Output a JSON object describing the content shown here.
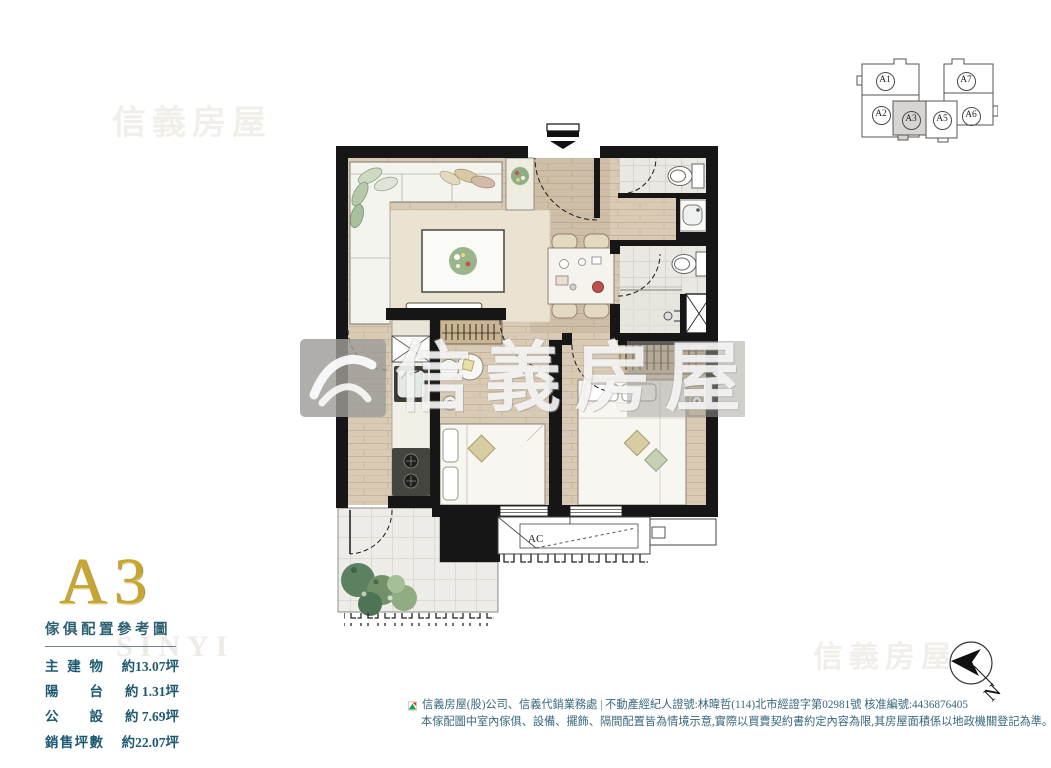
{
  "meta": {
    "brand_cn": "信義房屋",
    "brand_en": "SINYI"
  },
  "colors": {
    "accent_teal": "#2c6172",
    "table_text": "#1d5a72",
    "gold": "#c7a531",
    "wall_black": "#161616",
    "wood_floor": "#d8cab4",
    "logo_green": "#1e9e4a",
    "logo_red": "#d03a2b"
  },
  "keyplan": {
    "units": [
      {
        "label": "A1",
        "highlighted": false
      },
      {
        "label": "A7",
        "highlighted": false
      },
      {
        "label": "A2",
        "highlighted": false
      },
      {
        "label": "A3",
        "highlighted": true
      },
      {
        "label": "A5",
        "highlighted": false
      },
      {
        "label": "A6",
        "highlighted": false
      }
    ]
  },
  "floorplan": {
    "ac_label": "AC"
  },
  "compass": {
    "north_label": "N"
  },
  "unit_info": {
    "unit_name": "A3",
    "subtitle": "傢俱配置參考圖",
    "areas": [
      {
        "label": "主建物",
        "value": "約13.07坪"
      },
      {
        "label": "陽台",
        "value": "約 1.31坪"
      },
      {
        "label": "公設",
        "value": "約 7.69坪"
      },
      {
        "label": "銷售坪數",
        "value": "約22.07坪"
      }
    ]
  },
  "footer": {
    "line1": "信義房屋(股)公司、信義代銷業務處 | 不動產經紀人證號:林暐哲(114)北市經證字第02981號 核准編號:4436876405",
    "line2": "本傢配圖中室內傢俱、設備、擺飾、隔間配置皆為情境示意,實際以買賣契約書約定內容為限,其房屋面積係以地政機關登記為準。"
  }
}
